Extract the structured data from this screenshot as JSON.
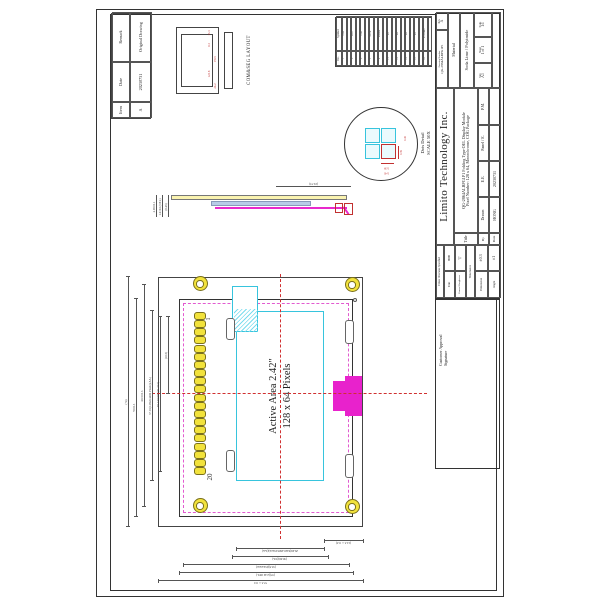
{
  "sheet": {
    "company": "Limito  Technology  Inc.",
    "title_label": "Title",
    "title_line1": "QG-2864ALBPG1P1 Folding Type OEL Display Module",
    "title_line2": "Pixel Number: 128 x 64, Monochrome, COG Package",
    "drawing_number_label": "Drawing Number",
    "drawing_number": "QG-2864ALBPG1P1",
    "rev_label": "Rev.",
    "rev": "A",
    "material_label": "Material",
    "material": "Soda Lime / Polyimide",
    "scale_label": "Scale",
    "scale": "1:1",
    "sheet_label": "Sheet",
    "sheet": "1 of 1",
    "size_label": "Size",
    "size": "A3",
    "by_label": "By",
    "date_label": "Date",
    "date": "20230731",
    "drawn_label": "Drawn",
    "drawn": "HONG",
    "ee_label": "E.E.",
    "panel_label": "Panel / E.",
    "pm_label": "P.M.",
    "tolerance": {
      "header": "Unless Otherwise Specified",
      "unit_label": "Unit",
      "unit": "mm",
      "rough_label": "General Roughness",
      "rough": "▽",
      "tol_label": "Tolerance",
      "dim_label": "Dimension",
      "dim": "±0.3",
      "angle_label": "Angle",
      "angle": "±1"
    },
    "customer": {
      "line1": "Customer Approval",
      "line2": "Signature"
    }
  },
  "revision_table": {
    "headers": [
      "Item",
      "Date",
      "Remark"
    ],
    "rows": [
      [
        "A",
        "20230731",
        "Original Drawing"
      ]
    ]
  },
  "pin_table": {
    "headers": [
      "No.",
      "Symbol"
    ],
    "rows": [
      [
        "1",
        "VSS"
      ],
      [
        "2",
        "VDD"
      ],
      [
        "3",
        "BS1"
      ],
      [
        "4",
        "BS2"
      ],
      [
        "5",
        "CS#"
      ],
      [
        "6",
        "RES#"
      ],
      [
        "7",
        "D/C#"
      ],
      [
        "8",
        "R/W#"
      ],
      [
        "9",
        "E/RD#"
      ],
      [
        "10",
        "D0"
      ],
      [
        "11",
        "D1"
      ],
      [
        "12",
        "D2"
      ],
      [
        "13",
        "D3"
      ],
      [
        "14",
        "D4"
      ],
      [
        "15",
        "D5"
      ],
      [
        "16",
        "D6"
      ],
      [
        "17",
        "D7"
      ],
      [
        "18",
        "IREF"
      ],
      [
        "19",
        "VCOMH"
      ],
      [
        "20",
        "VCC"
      ]
    ]
  },
  "front_view": {
    "aa_line1": "Active Area 2.42\"",
    "aa_line2": "128 x 64 Pixels",
    "pin_first": "1",
    "pin_last": "20",
    "dims_top": [
      "(74)",
      "70±0.3",
      "60.5±0.3",
      "57.01(128x0.4486 Pixels)(AA)",
      "P1.143x19=(21.717)",
      "(10.5)"
    ],
    "dims_left": [
      "57.3±0.5",
      "(37)(2.42 OEL)",
      "(33.5)(Polarizer)",
      "(30.69)(VA)",
      "29.49(64x0.4606 Pixels)(AA)",
      "(12.3±0.3)"
    ]
  },
  "side_view": {
    "dims": [
      "2.05±0.1",
      "1.6±0.1(OEL)",
      "(0.45)"
    ],
    "span_dim": "(19.73)"
  },
  "dots_detail": {
    "label1": "Dots Detail",
    "label2": "SCALE 50X",
    "dims": [
      "0.39",
      "0.39",
      "0.45",
      "0.45"
    ]
  },
  "comseg": {
    "label": "COM&SEG LAYOUT",
    "dims": [
      "13.3",
      "0.3",
      "123.8",
      "26.2",
      "P0.5"
    ]
  },
  "colors": {
    "pad_yellow": "#f2e23c",
    "active_cyan": "#37c4dd",
    "connector_magenta": "#e822cc",
    "dim_red": "#c23030"
  }
}
